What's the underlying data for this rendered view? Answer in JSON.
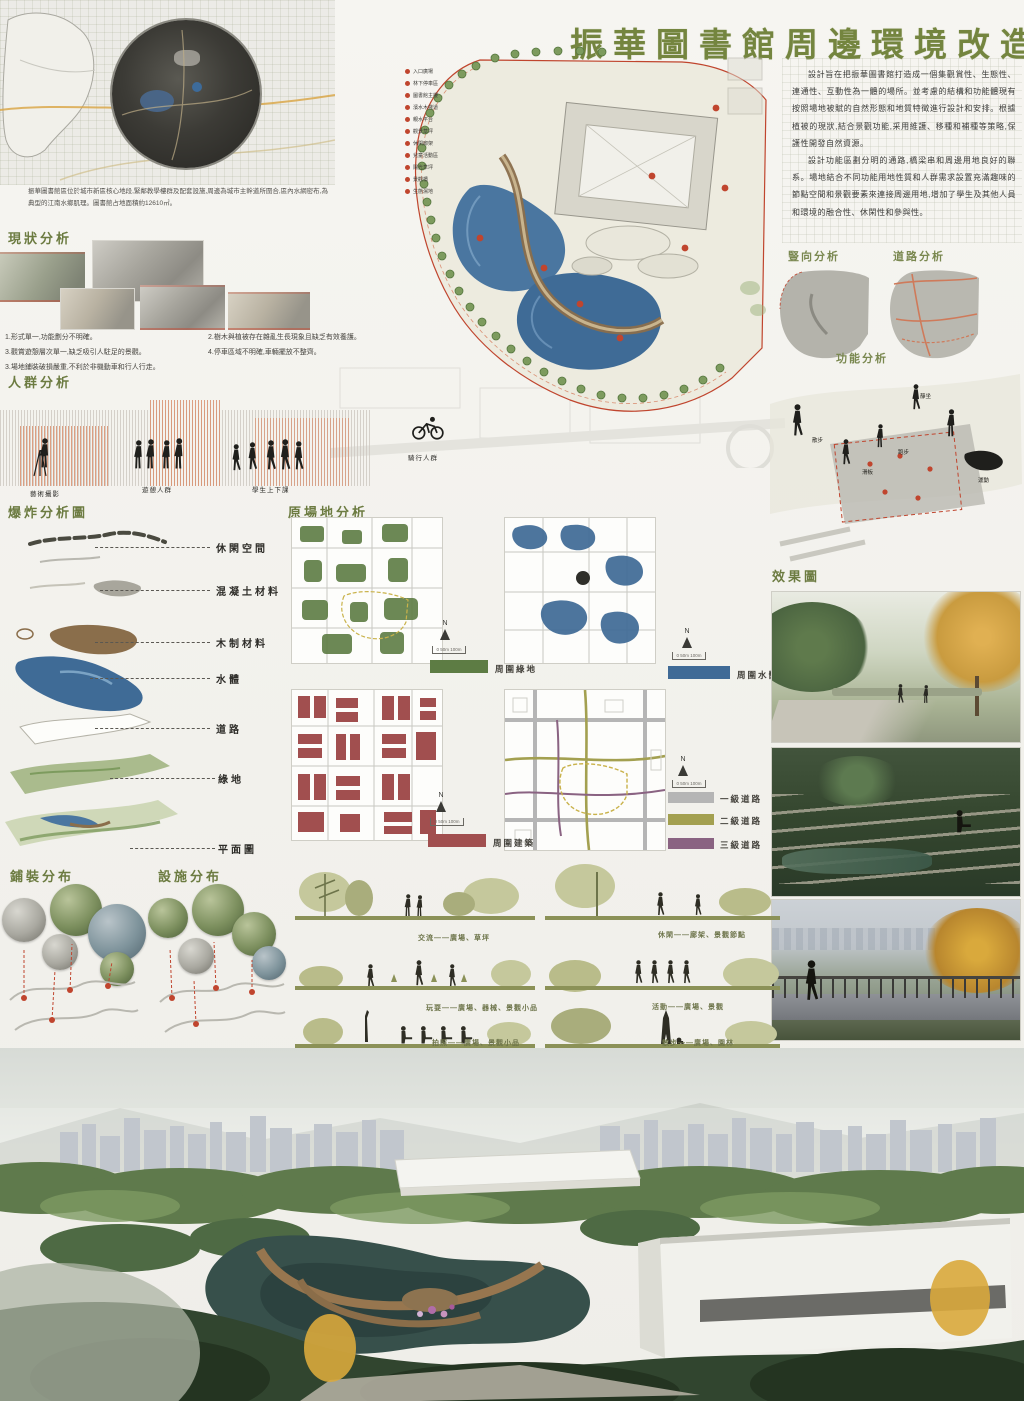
{
  "title": "振華圖書館周邊環境改造",
  "intro": {
    "p1": "設計旨在把振華圖書館打造成一個集觀賞性、生態性、連通性、互動性為一體的場所。並考慮的結構和功能體現有按照場地被賦的自然形態和地質特徵進行設計和安排。根據植被的現狀,結合景觀功能,采用維護、移種和補種等策略,保護性開發自然資源。",
    "p2": "設計功能區劃分明的通路,橋梁串和周邊用地良好的聯系。場地結合不同功能用地性質和人群需求設置充滿趣味的節點空間和景觀要素來連接周邊用地,增加了學生及其他人員和環境的融合性、休閑性和參與性。"
  },
  "location": {
    "caption": "振華圖書館區位於城市新區核心地段,緊鄰教學樓群及配套設施,周邊為城市主幹道所圍合,區內水網密布,為典型的江南水鄉肌理。圖書館占地面積約12610㎡。"
  },
  "headers": {
    "status": "現狀分析",
    "crowd": "人群分析",
    "exploded": "爆炸分析圖",
    "site": "原場地分析",
    "vertical": "豎向分析",
    "road": "道路分析",
    "function": "功能分析",
    "render": "效果圖",
    "paving": "鋪裝分布",
    "facility": "設施分布"
  },
  "status_notes": {
    "n1": "1.形式單一,功能劃分不明確。",
    "n3": "3.觀賞遊憩層次單一,缺乏吸引人駐足的景觀。",
    "n5": "3.場地鋪裝破損嚴重,不利於非機動車和行人行走。",
    "n2": "2.樹木與植被存在雜亂生長現象且缺乏有效養護。",
    "n4": "4.停車區域不明確,車輛擺放不整齊。"
  },
  "crowd_labels": {
    "photo": "藝術攝影",
    "leisure": "遊憩人群",
    "students": "學生上下課",
    "passing": "騎行人群"
  },
  "exploded_labels": [
    "休閑空間",
    "混凝土材料",
    "木制材料",
    "水體",
    "道路",
    "綠地",
    "平面圖"
  ],
  "site_legends": {
    "green": "周圍綠地",
    "water": "周圍水體",
    "building": "周圍建築",
    "road1": "一級道路",
    "road2": "二級道路",
    "road3": "三級道路"
  },
  "compass": {
    "n": "N",
    "scale": "0  50m 100m"
  },
  "plan_key": {
    "items": [
      "入口廣場",
      "林下停車區",
      "圖書館主樓",
      "濱水木棧道",
      "親水平台",
      "觀景草坪",
      "休閑廊架",
      "兒童活動區",
      "陽光草坪",
      "景觀橋",
      "生態濕地"
    ]
  },
  "activities": [
    "散步",
    "滑板",
    "跑步",
    "靜坐",
    "運動"
  ],
  "sections": {
    "s1": "交流——廣場、草坪",
    "s2": "玩耍——廣場、器械、景觀小品",
    "s3": "拍照——廣場、景觀小品",
    "s4": "休閑——廊架、景觀節點",
    "s5": "活動——廣場、景觀",
    "s6": "散步——廣場、園林"
  },
  "colors": {
    "accent_green": "#6c7b41",
    "water_blue": "#44719c",
    "legend_green": "#5d7c44",
    "legend_blue": "#3f6a96",
    "legend_red": "#a14f4f",
    "road_gray": "#b5b5b5",
    "road_olive": "#a3a050",
    "road_purple": "#8a6382",
    "boundary_red": "#c0452e"
  }
}
